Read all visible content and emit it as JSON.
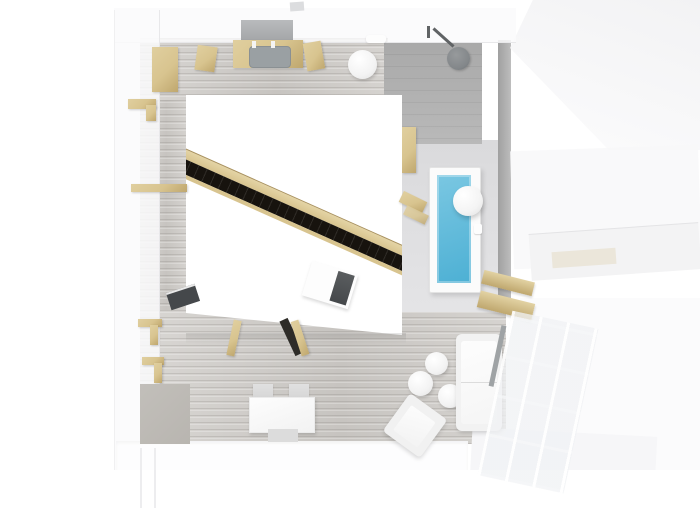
{
  "scene": {
    "title": "Top-down 3D render of a studio apartment floor plan"
  },
  "colors": {
    "bg": "#ffffff",
    "wall_translucent": "rgba(250,250,251,0.85)",
    "wall_edge": "#e8e8ea",
    "wood_floor": "#cfccc8",
    "wood_accent": "#d8c48f",
    "wood_accent_dark": "#bfa76e",
    "stair_black": "#17130e",
    "water_blue": "#4db0d4",
    "water_blue_light": "#7ac7e2",
    "tile_gray": "#b9b9b9",
    "tile_gray_dark": "#a9a9a9",
    "bath_floor": "#dadadc",
    "partition_gray": "#a0a0a0",
    "furniture_white": "#f2f2f2",
    "rug_gray": "#b8b5b0",
    "tv_gray": "#a5a7a9",
    "seat_gray": "#9aa0a3",
    "laptop_dark": "#45484b",
    "chair_gray": "#d7d7d7",
    "window_frame_dark": "#9fa3a5",
    "shower_metal": "#83878a"
  },
  "objects": {
    "floor": {
      "label": "Whitewashed wood floor"
    },
    "loft": {
      "label": "White loft cube with diagonal stair opening"
    },
    "stair": {
      "label": "Diagonal staircase channel"
    },
    "laptop_top": {
      "label": "Laptop on loft roof"
    },
    "ladder": {
      "label": "Ladder to loft"
    },
    "wardrobe": {
      "label": "Wardrobe"
    },
    "desk": {
      "label": "Desk with chair"
    },
    "tv": {
      "label": "Wall-mounted TV"
    },
    "chair": {
      "label": "Wooden chair"
    },
    "stool": {
      "label": "Round stool"
    },
    "shower": {
      "label": "Tiled shower area"
    },
    "showerhead": {
      "label": "Rain shower head"
    },
    "partition": {
      "label": "Bathroom partition wall"
    },
    "cabinet": {
      "label": "Bathroom cabinet"
    },
    "bathtub": {
      "label": "Bathtub with blue water"
    },
    "sphere_lamp": {
      "label": "White sphere lamp"
    },
    "shelf": {
      "label": "Wooden wall shelf"
    },
    "rug": {
      "label": "Gray rug"
    },
    "dining_table": {
      "label": "Dining table"
    },
    "dining_chair": {
      "label": "Dining chair"
    },
    "sofa": {
      "label": "White sofa"
    },
    "coffee_table": {
      "label": "Round coffee table"
    },
    "armchair": {
      "label": "Armchair"
    },
    "window": {
      "label": "Glazed window wall"
    }
  }
}
